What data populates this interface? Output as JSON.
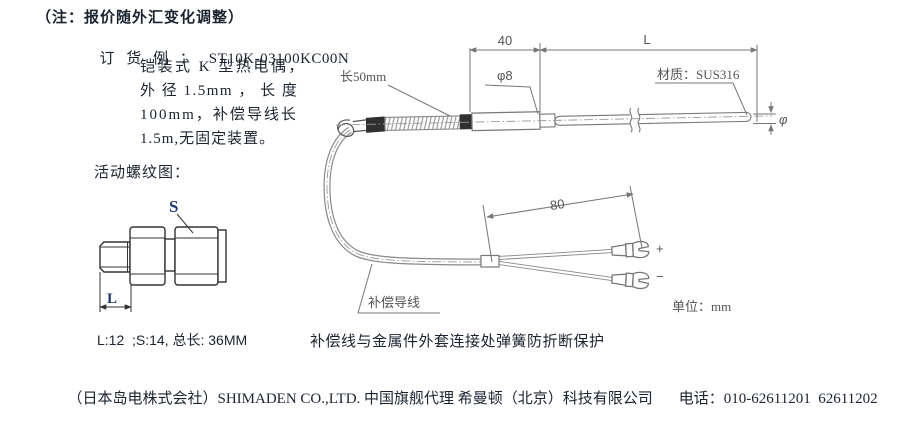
{
  "colors": {
    "text": "#1c2430",
    "accent_navy": "#1f3a6e",
    "sketch_gray": "#777777",
    "sketch_dark": "#333333",
    "crimp_black": "#2f2f2f"
  },
  "note": "（注：报价随外汇变化调整）",
  "order": {
    "label": "订 货 例 ：",
    "code": "ST10K-03100KC00N",
    "line2": "铠装式 K 型热电偶，",
    "line3": "外 径 1.5mm ， 长 度",
    "line4": "100mm，补偿导线长",
    "line5": "1.5m,无固定装置。"
  },
  "thread_figure": {
    "title": "活动螺纹图：",
    "s_label": "S",
    "l_label": "L",
    "dims": "L:12  ;S:14, 总长: 36MM"
  },
  "drawing": {
    "dim40": "40",
    "dimL": "L",
    "sleeve_len": "长50mm",
    "dia8": "φ8",
    "material": "材质：SUS316",
    "dia": "φ",
    "dim80": "80",
    "cable": "补偿导线",
    "unit": "单位：mm",
    "plus": "+",
    "minus": "−"
  },
  "caption": "补偿线与金属件外套连接处弹簧防折断保护",
  "footer": {
    "company": "（日本岛电株式会社）SHIMADEN CO.,LTD. 中国旗舰代理 希曼顿（北京）科技有限公司",
    "phone": "电话：010-62611201  62611202"
  }
}
